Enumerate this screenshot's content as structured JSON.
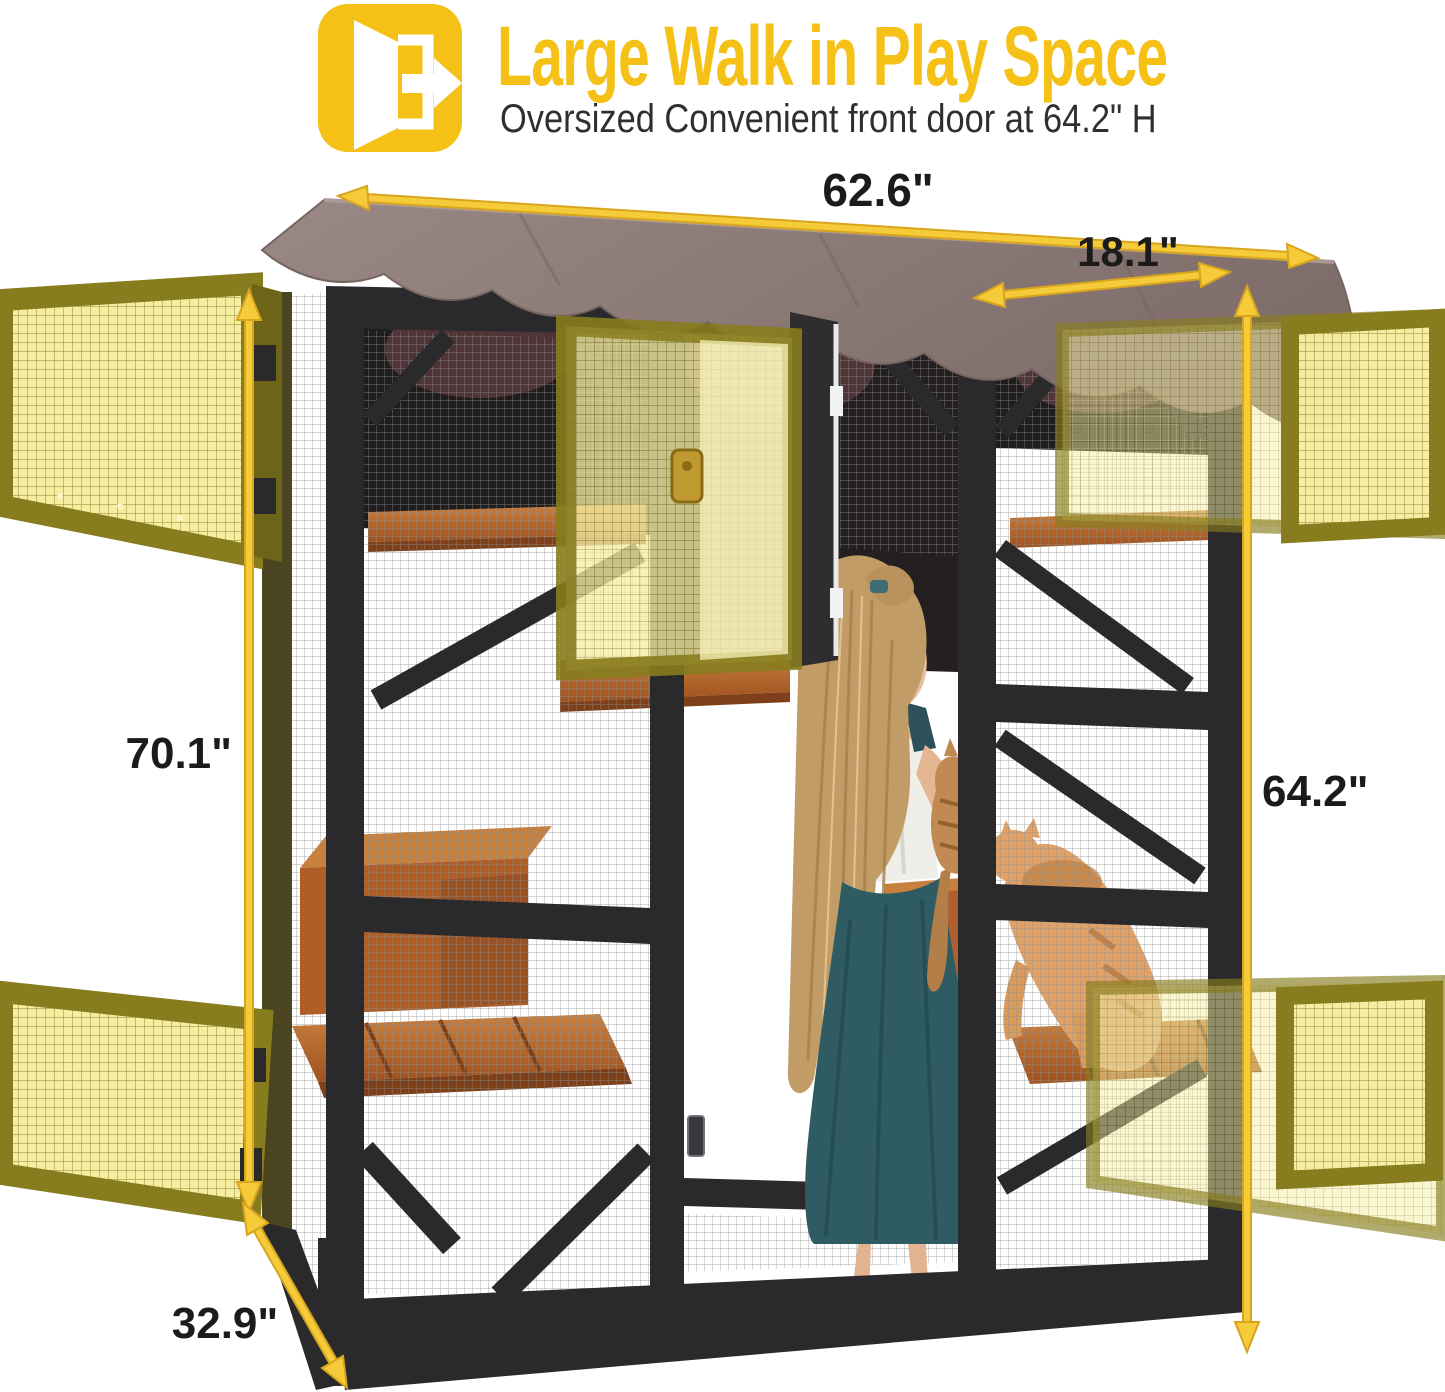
{
  "header": {
    "title": "Large Walk in Play Space",
    "subtitle": "Oversized Convenient front door at 64.2\" H",
    "icon": "exit-door-icon",
    "accent_color": "#F5C117",
    "subtitle_color": "#2F2F2F"
  },
  "diagram": {
    "dimensions": {
      "overall_width": "62.6\"",
      "door_width": "18.1\"",
      "overall_height": "70.1\"",
      "door_height": "64.2\"",
      "depth": "32.9\""
    },
    "colors": {
      "arrow_yellow": "#F6CB39",
      "arrow_edge": "#D8A51E",
      "door_highlight": "#F5EDA0",
      "door_frame_olive": "#877C1E",
      "roof_brown": "#8C7975",
      "frame_black": "#2A2A2D",
      "wood_orange": "#AF5E28"
    }
  }
}
